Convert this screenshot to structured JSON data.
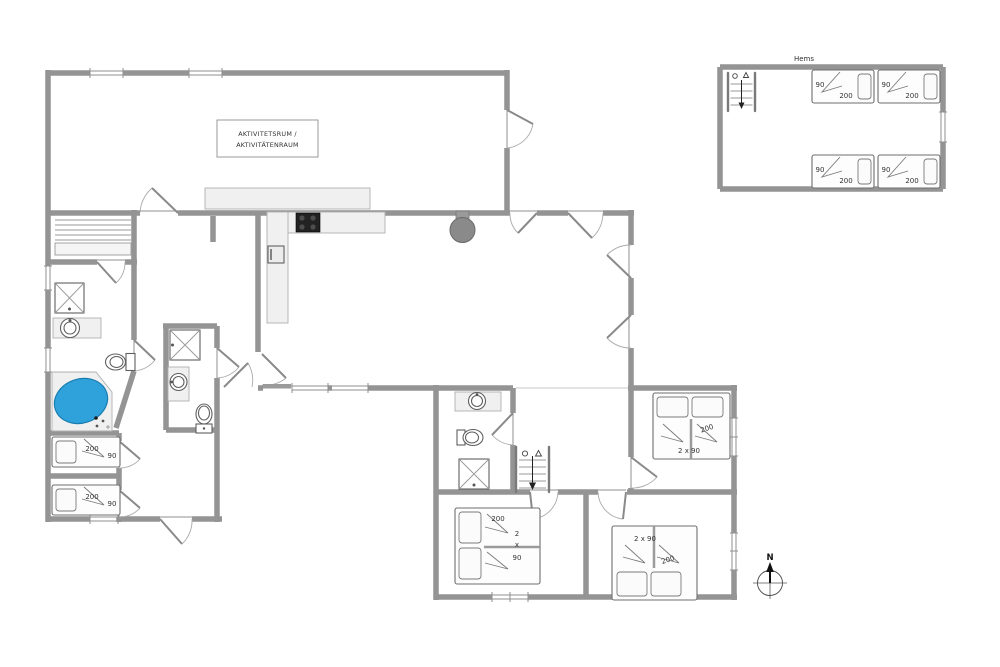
{
  "floor_plan": {
    "activity_room_label": {
      "line1": "AKTIVITETSRUM /",
      "line2": "AKTIVITÄTENRAUM"
    },
    "annex_label": "Hems",
    "compass_north": "N",
    "beds": {
      "hems": [
        {
          "width": "90",
          "length": "200"
        },
        {
          "width": "90",
          "length": "200"
        },
        {
          "width": "90",
          "length": "200"
        },
        {
          "width": "90",
          "length": "200"
        }
      ],
      "left_wing": [
        {
          "length": "200",
          "width": "90"
        },
        {
          "length": "200",
          "width": "90"
        }
      ],
      "bedroom_sw_double": {
        "length": "200",
        "width_digit": "2",
        "width_times": "x",
        "width_value": "90"
      },
      "bedroom_s_double": {
        "width": "2 x 90",
        "length": "200"
      },
      "bedroom_e_double": {
        "width": "2 x 90",
        "length": "200"
      }
    },
    "colors": {
      "bathtub_blue": "#2FA2DC",
      "wall_gray": "#949494"
    }
  }
}
